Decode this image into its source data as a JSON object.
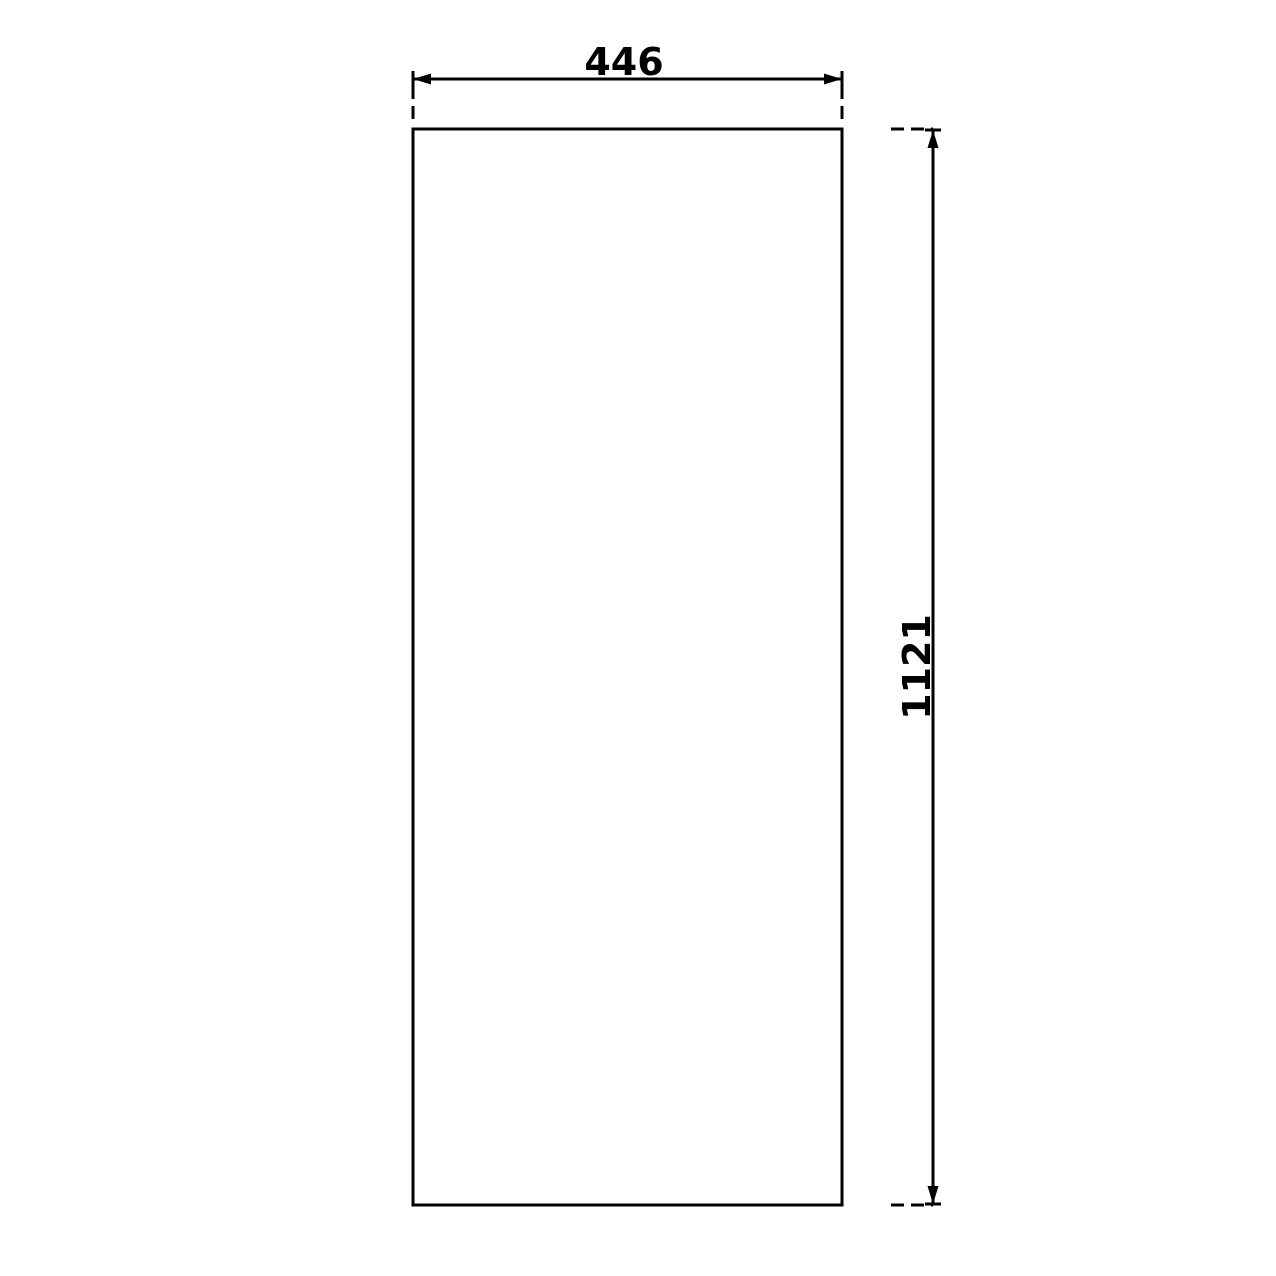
{
  "colors": {
    "line": "#000000",
    "background": "#ffffff"
  },
  "drawing": {
    "width_dimension": {
      "label": "446"
    },
    "height_dimension": {
      "label": "1121"
    }
  }
}
